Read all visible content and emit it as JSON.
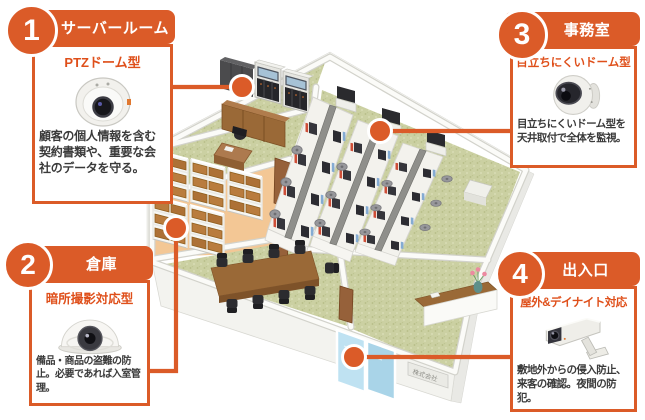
{
  "colors": {
    "accent_orange": "#DB5B28",
    "subtitle_orange": "#DF4F1A",
    "wall_white": "#F2F2EE",
    "office_floor_green": "#CBD0A2",
    "warehouse_floor_orange": "#F3C795",
    "entrance_glass_blue": "#BFE2F2"
  },
  "callouts": [
    {
      "number": "1",
      "room": "サーバールーム",
      "camera_type": "PTZドーム型",
      "description": "顧客の個人情報を含む契約書類や、重要な会社のデータを守る。",
      "camera_icon": "ptz-dome-camera"
    },
    {
      "number": "2",
      "room": "倉庫",
      "camera_type": "暗所撮影対応型",
      "description": "備品・商品の盗難の防止。必要であれば入室管理。",
      "camera_icon": "low-light-dome-camera"
    },
    {
      "number": "3",
      "room": "事務室",
      "camera_type": "目立ちにくいドーム型",
      "description": "目立ちにくいドーム型を天井取付で全体を監視。",
      "camera_icon": "discreet-dome-camera"
    },
    {
      "number": "4",
      "room": "出入口",
      "camera_type": "屋外&デイナイト対応",
      "description": "敷地外からの侵入防止、来客の確認。夜間の防犯。",
      "camera_icon": "outdoor-box-camera"
    }
  ],
  "floorplan": {
    "entrance_sign_label": "株式会社",
    "markers": [
      "server-room-camera",
      "warehouse-camera",
      "office-camera",
      "entrance-camera"
    ]
  }
}
